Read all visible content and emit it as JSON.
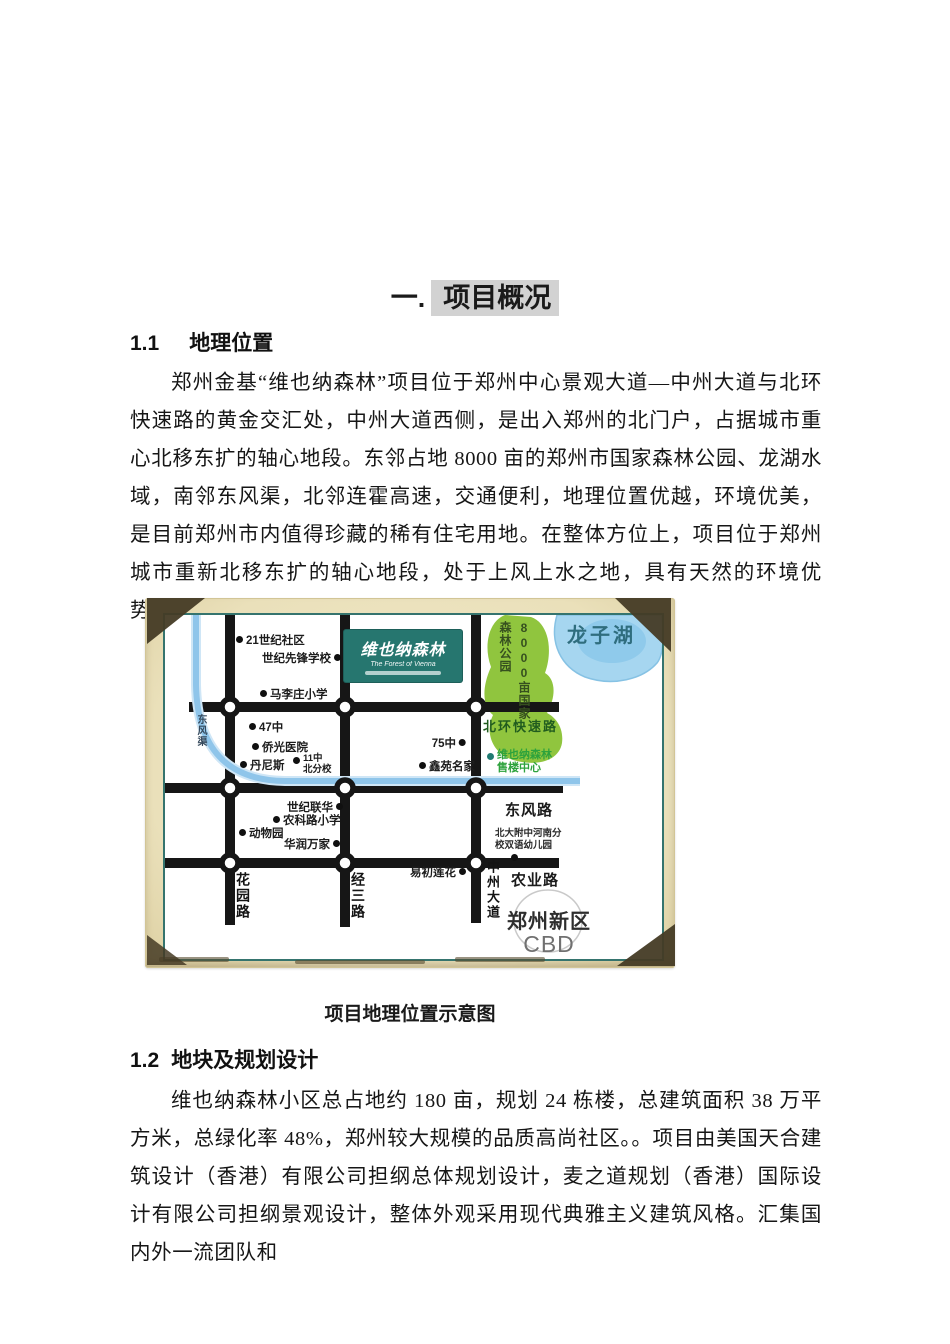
{
  "document": {
    "title": {
      "prefix": "一.",
      "highlight": "项目概况"
    },
    "section_1_1": {
      "number": "1.1",
      "title": "地理位置",
      "paragraph": "郑州金基“维也纳森林”项目位于郑州中心景观大道—中州大道与北环快速路的黄金交汇处，中州大道西侧，是出入郑州的北门户，占据城市重心北移东扩的轴心地段。东邻占地 8000 亩的郑州市国家森林公园、龙湖水域，南邻东风渠，北邻连霍高速，交通便利，地理位置优越，环境优美，是目前郑州市内值得珍藏的稀有住宅用地。在整体方位上，项目位于郑州城市重新北移东扩的轴心地段，处于上风上水之地，具有天然的环境优势。"
    },
    "figure_caption": "项目地理位置示意图",
    "section_1_2": {
      "number": "1.2",
      "title": "地块及规划设计",
      "paragraph": "维也纳森林小区总占地约 180 亩，规划 24 栋楼，总建筑面积 38 万平方米，总绿化率 48%，郑州较大规模的品质高尚社区。。项目由美国天合建筑设计（香港）有限公司担纲总体规划设计，麦之道规划（香港）国际设计有限公司担纲景观设计，整体外观采用现代典雅主义建筑风格。汇集国内外一流团队和"
    }
  },
  "map": {
    "logo": {
      "name": "维也纳森林",
      "subtitle": "The Forest of Vienna"
    },
    "lake": "龙子湖",
    "forest": {
      "col1": "8000亩国家",
      "col2": "森林公园"
    },
    "roads": {
      "north_ring": "北环快速路",
      "dongfeng_canal": "东风渠",
      "dongfeng_road": "东风路",
      "nongye_road": "农业路",
      "huayuan_road": "花园路",
      "jingsan_road": "经三路",
      "zhongzhou_ave": "中州大道"
    },
    "sales_center": {
      "line1": "维也纳森林",
      "line2": "售楼中心"
    },
    "cbd": {
      "line1": "郑州新区",
      "line2": "CBD"
    },
    "beida": {
      "line1": "北大附中河南分",
      "line2": "校双语幼儿园"
    },
    "places": [
      {
        "label": "21世纪社区"
      },
      {
        "label": "世纪先锋学校"
      },
      {
        "label": "马李庄小学"
      },
      {
        "label": "47中"
      },
      {
        "label": "侨光医院"
      },
      {
        "label": "丹尼斯"
      },
      {
        "line1": "11中",
        "line2": "北分校"
      },
      {
        "label": "75中"
      },
      {
        "label": "鑫苑名家"
      },
      {
        "label": "世纪联华"
      },
      {
        "label": "农科路小学"
      },
      {
        "label": "动物园"
      },
      {
        "label": "华润万家"
      },
      {
        "label": "易初莲花"
      }
    ]
  }
}
